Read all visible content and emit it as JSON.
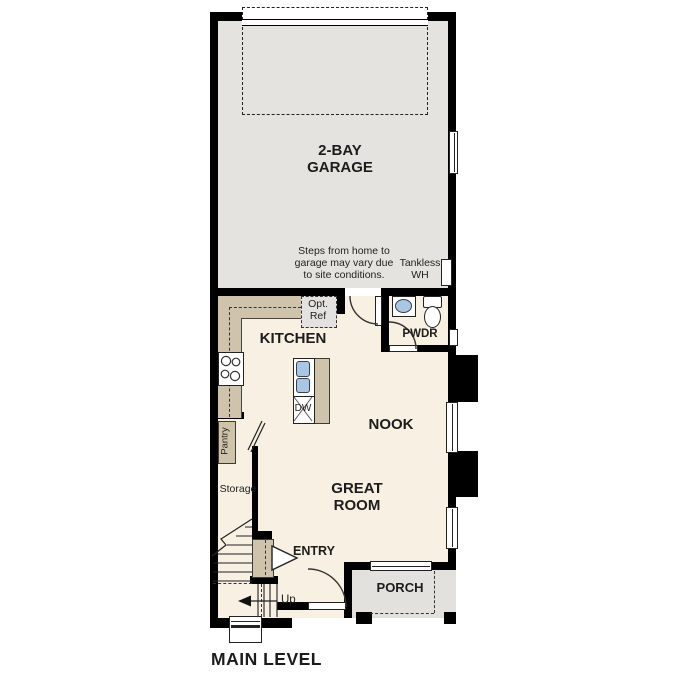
{
  "plan_title": "MAIN LEVEL",
  "labels": {
    "garage_line1": "2-BAY",
    "garage_line2": "GARAGE",
    "steps_note_line1": "Steps from home to",
    "steps_note_line2": "garage may vary due",
    "steps_note_line3": "to site conditions.",
    "tankless_line1": "Tankless",
    "tankless_line2": "WH",
    "opt_ref_line1": "Opt.",
    "opt_ref_line2": "Ref",
    "kitchen": "KITCHEN",
    "pwdr": "PWDR",
    "nook": "NOOK",
    "great_room_line1": "GREAT",
    "great_room_line2": "ROOM",
    "pantry": "Pantry",
    "storage": "Storage",
    "entry": "ENTRY",
    "up": "Up",
    "porch": "PORCH",
    "dw": "DW",
    "main_level": "MAIN LEVEL"
  },
  "colors": {
    "wall": "#000000",
    "interior_floor": "#f8f0e2",
    "garage_floor": "#e4e3e0",
    "porch_floor": "#e2e1de",
    "cabinet_tan": "#cfc3ab",
    "sink_blue": "#a9c6e4"
  }
}
